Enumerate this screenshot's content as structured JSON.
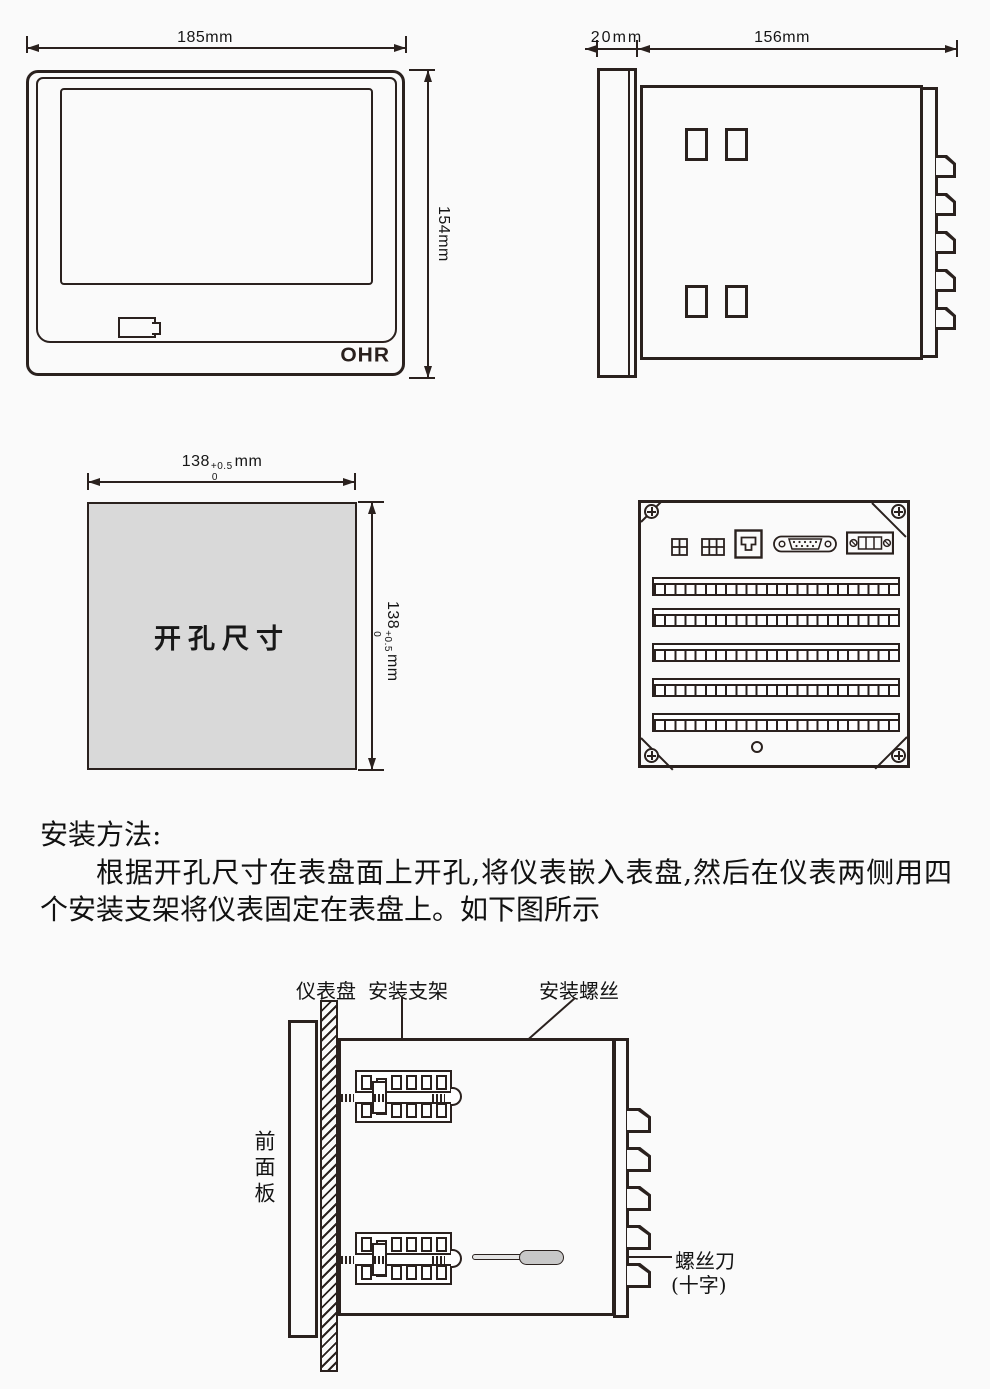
{
  "front_view": {
    "width_dim": "185mm",
    "height_dim": "154mm",
    "brand": "OHR"
  },
  "side_view": {
    "bezel_dim": "20mm",
    "depth_dim": "156mm"
  },
  "cutout_view": {
    "label": "开孔尺寸",
    "width_dim": {
      "value": "138",
      "tol_plus": "+0.5",
      "tol_minus": "0",
      "unit": "mm"
    },
    "height_dim": {
      "value": "138",
      "tol_plus": "+0.5",
      "tol_minus": "0",
      "unit": "mm"
    }
  },
  "instructions": {
    "heading": "安装方法:",
    "body": "根据开孔尺寸在表盘面上开孔,将仪表嵌入表盘,然后在仪表两侧用四个安装支架将仪表固定在表盘上。如下图所示"
  },
  "install_diagram": {
    "labels": {
      "panel": "仪表盘",
      "bracket": "安装支架",
      "screw": "安装螺丝",
      "screwdriver": "螺丝刀",
      "screwdriver_type": "(十字)",
      "front_panel": "前面板"
    }
  }
}
